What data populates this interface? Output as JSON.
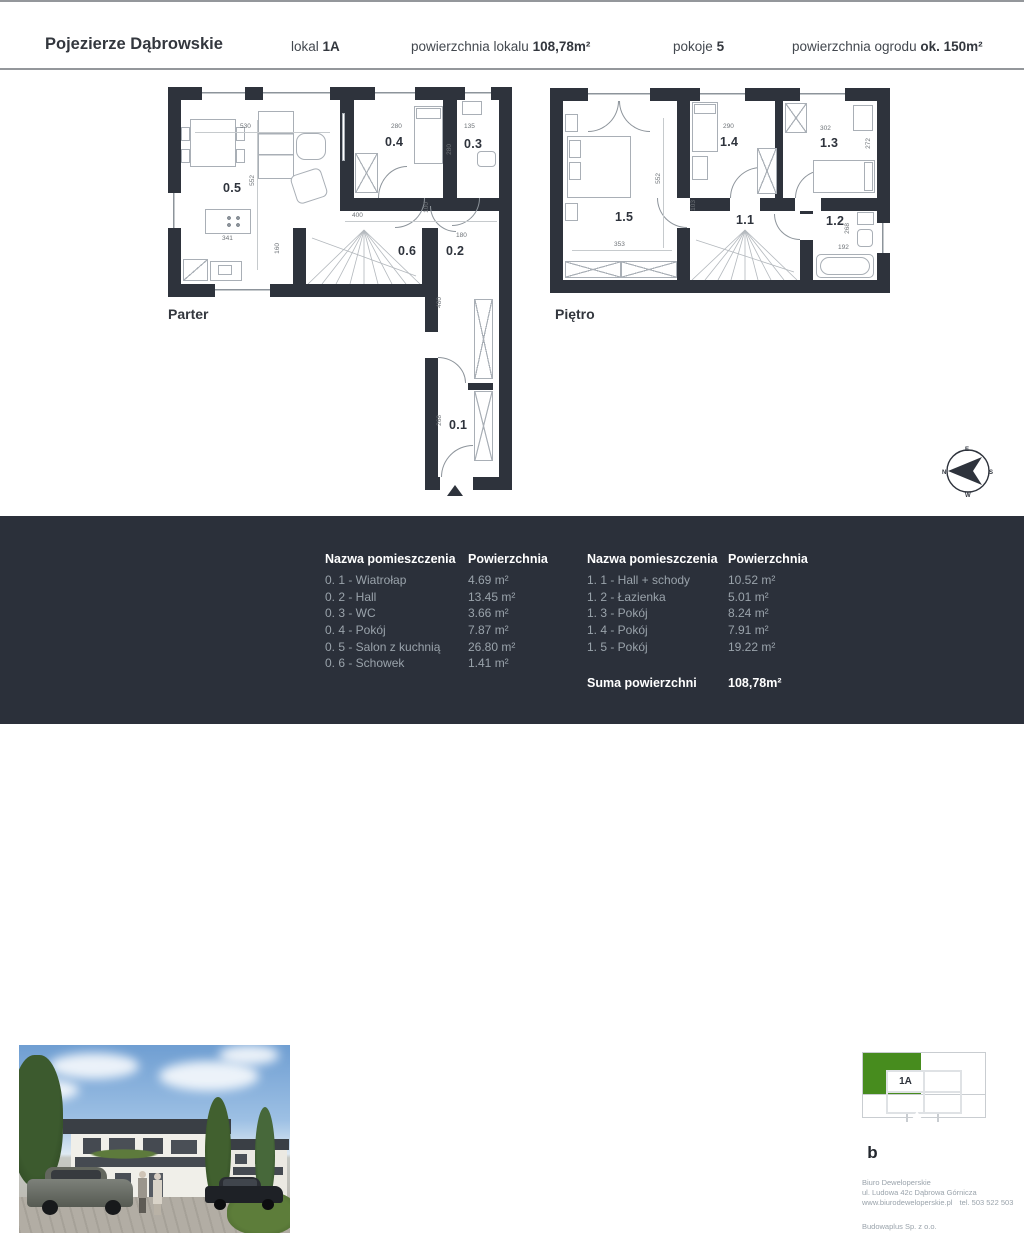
{
  "colors": {
    "wall": "#2e333c",
    "panel": "#2b303a",
    "green": "#478c1e",
    "muted": "#9aa3ab",
    "dimc": "#6d7277",
    "linec": "#8d949b",
    "furn": "#a9afb6"
  },
  "header": {
    "project": "Pojezierze Dąbrowskie",
    "lokal_label": "lokal",
    "lokal_value": "1A",
    "area_label": "powierzchnia lokalu",
    "area_value": "108,78m²",
    "rooms_label": "pokoje",
    "rooms_value": "5",
    "garden_label": "powierzchnia ogrodu",
    "garden_value": "ok. 150m²"
  },
  "plans": {
    "parter": {
      "title": "Parter",
      "rooms": {
        "r01": "0.1",
        "r02": "0.2",
        "r03": "0.3",
        "r04": "0.4",
        "r05": "0.5",
        "r06": "0.6"
      },
      "dims": {
        "d530": "530",
        "d552": "552",
        "d341": "341",
        "d280a": "280",
        "d135": "135",
        "d280b": "280",
        "d400": "400",
        "d100": "100",
        "d180": "180",
        "d160": "160",
        "d480": "480",
        "d268": "268"
      }
    },
    "pietro": {
      "title": "Piętro",
      "rooms": {
        "r11": "1.1",
        "r12": "1.2",
        "r13": "1.3",
        "r14": "1.4",
        "r15": "1.5"
      },
      "dims": {
        "d552": "552",
        "d353": "353",
        "d290": "290",
        "d302": "302",
        "d272": "272",
        "d103": "103",
        "d268": "268",
        "d192": "192"
      }
    }
  },
  "tables": {
    "col_name": "Nazwa pomieszczenia",
    "col_area": "Powierzchnia",
    "ground": [
      {
        "name": "0. 1 - Wiatrołap",
        "area": "4.69 m²"
      },
      {
        "name": "0. 2 - Hall",
        "area": "13.45 m²"
      },
      {
        "name": "0. 3 - WC",
        "area": "3.66 m²"
      },
      {
        "name": "0. 4 - Pokój",
        "area": "7.87 m²"
      },
      {
        "name": "0. 5 - Salon z kuchnią",
        "area": "26.80 m²"
      },
      {
        "name": "0. 6 - Schowek",
        "area": "1.41 m²"
      }
    ],
    "upper": [
      {
        "name": "1. 1 - Hall + schody",
        "area": "10.52 m²"
      },
      {
        "name": "1. 2 - Łazienka",
        "area": "5.01 m²"
      },
      {
        "name": "1. 3 - Pokój",
        "area": "8.24 m²"
      },
      {
        "name": "1. 4 - Pokój",
        "area": "7.91 m²"
      },
      {
        "name": "1. 5 - Pokój",
        "area": "19.22 m²"
      }
    ],
    "sum_label": "Suma powierzchni",
    "sum_value": "108,78m²"
  },
  "unit_selector": {
    "c1a": "1A",
    "c2a": "2A",
    "c1b": "1B",
    "c2b": "2B",
    "selected": "1A"
  },
  "developer": {
    "logo_b": "b",
    "logo_dew": "dew",
    "logo_line1": "biuro",
    "logo_line2": "deweloperskie",
    "sales_label": "Biuro sprzedaży:",
    "sales_name": "Biuro Deweloperskie",
    "sales_address": "ul. Ludowa 42c Dąbrowa Górnicza",
    "sales_www": "www.biurodeweloperskie.pl",
    "sales_tel": "tel. 503 522 503",
    "dev_label": "Deweloper realizujący inwestycję:",
    "dev_name": "Budowaplus Sp. z o.o."
  },
  "compass": {
    "n": "N",
    "e": "E",
    "s": "S",
    "w": "W"
  }
}
